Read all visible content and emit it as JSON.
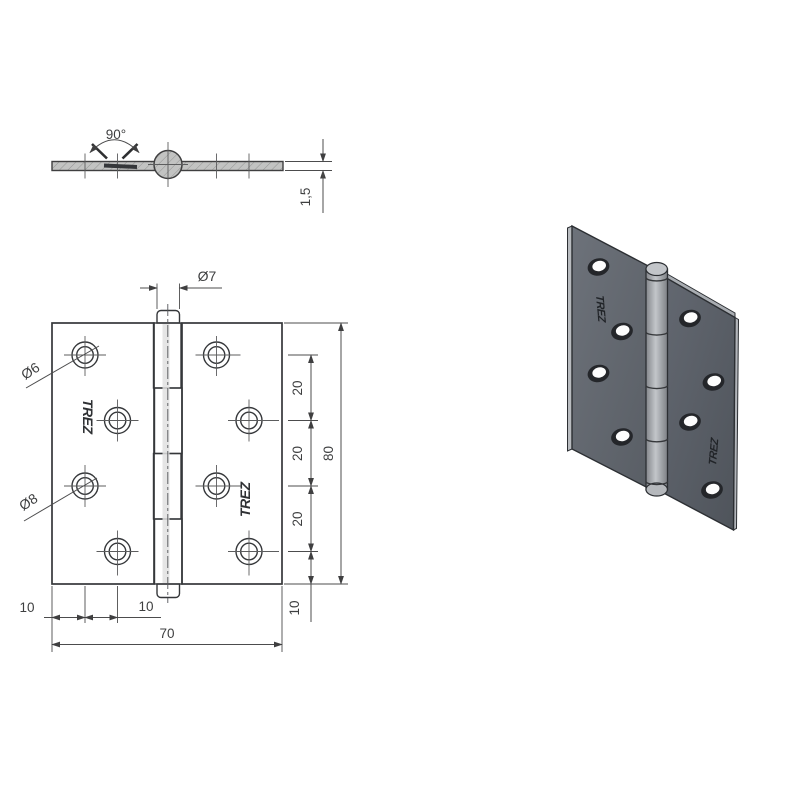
{
  "brand_stamp": "TREZ",
  "profile_view": {
    "opening_angle": "90°",
    "leaf_thickness": "1,5"
  },
  "front_view": {
    "pin_diameter": "Ø7",
    "hole_diameter_small": "Ø6",
    "hole_diameter_large": "Ø8",
    "hole_spacing": [
      "20",
      "20",
      "20"
    ],
    "leaf_height": "80",
    "bottom_hole_offset": "10",
    "edge_hole_offset": "10",
    "hole_column_offset": "10",
    "leaf_width": "70"
  },
  "colors": {
    "background": "#ffffff",
    "plate_fill": "#c6c7c6",
    "object_line": "#35373a",
    "dimension_line": "#4c4c4d",
    "leaf_3d_dark": "#575c63",
    "leaf_3d_light": "#6a6f77",
    "barrel_3d": "#b4b8bc",
    "hole_ring_3d": "#24262a"
  }
}
